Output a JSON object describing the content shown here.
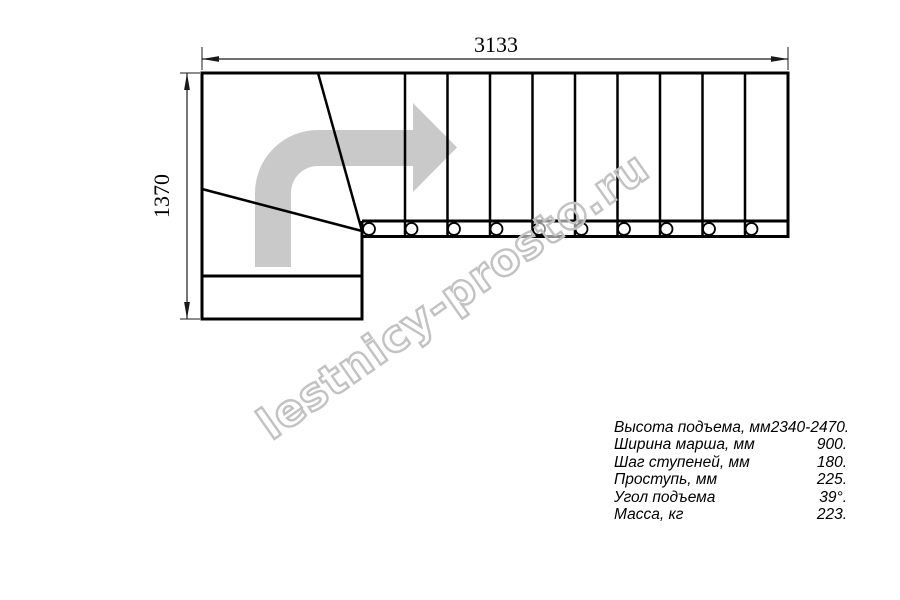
{
  "drawing": {
    "type": "staircase-plan-quarter-turn",
    "dim_width_mm": "3133",
    "dim_height_mm": "1370",
    "straight_steps": 10,
    "line_color": "#000000",
    "arrow_color": "#c9c9c9"
  },
  "watermark": {
    "text": "lestnicy-prosto.ru",
    "stroke_color": "#c2c2c2"
  },
  "specs": {
    "rows": [
      {
        "label": "Высота подъема, мм",
        "value": "2340-2470."
      },
      {
        "label": "Ширина марша, мм",
        "value": "900."
      },
      {
        "label": "Шаг ступеней, мм",
        "value": "180."
      },
      {
        "label": "Проступь, мм",
        "value": "225."
      },
      {
        "label": "Угол подъема",
        "value": "39°."
      },
      {
        "label": "Масса, кг",
        "value": "223."
      }
    ]
  }
}
